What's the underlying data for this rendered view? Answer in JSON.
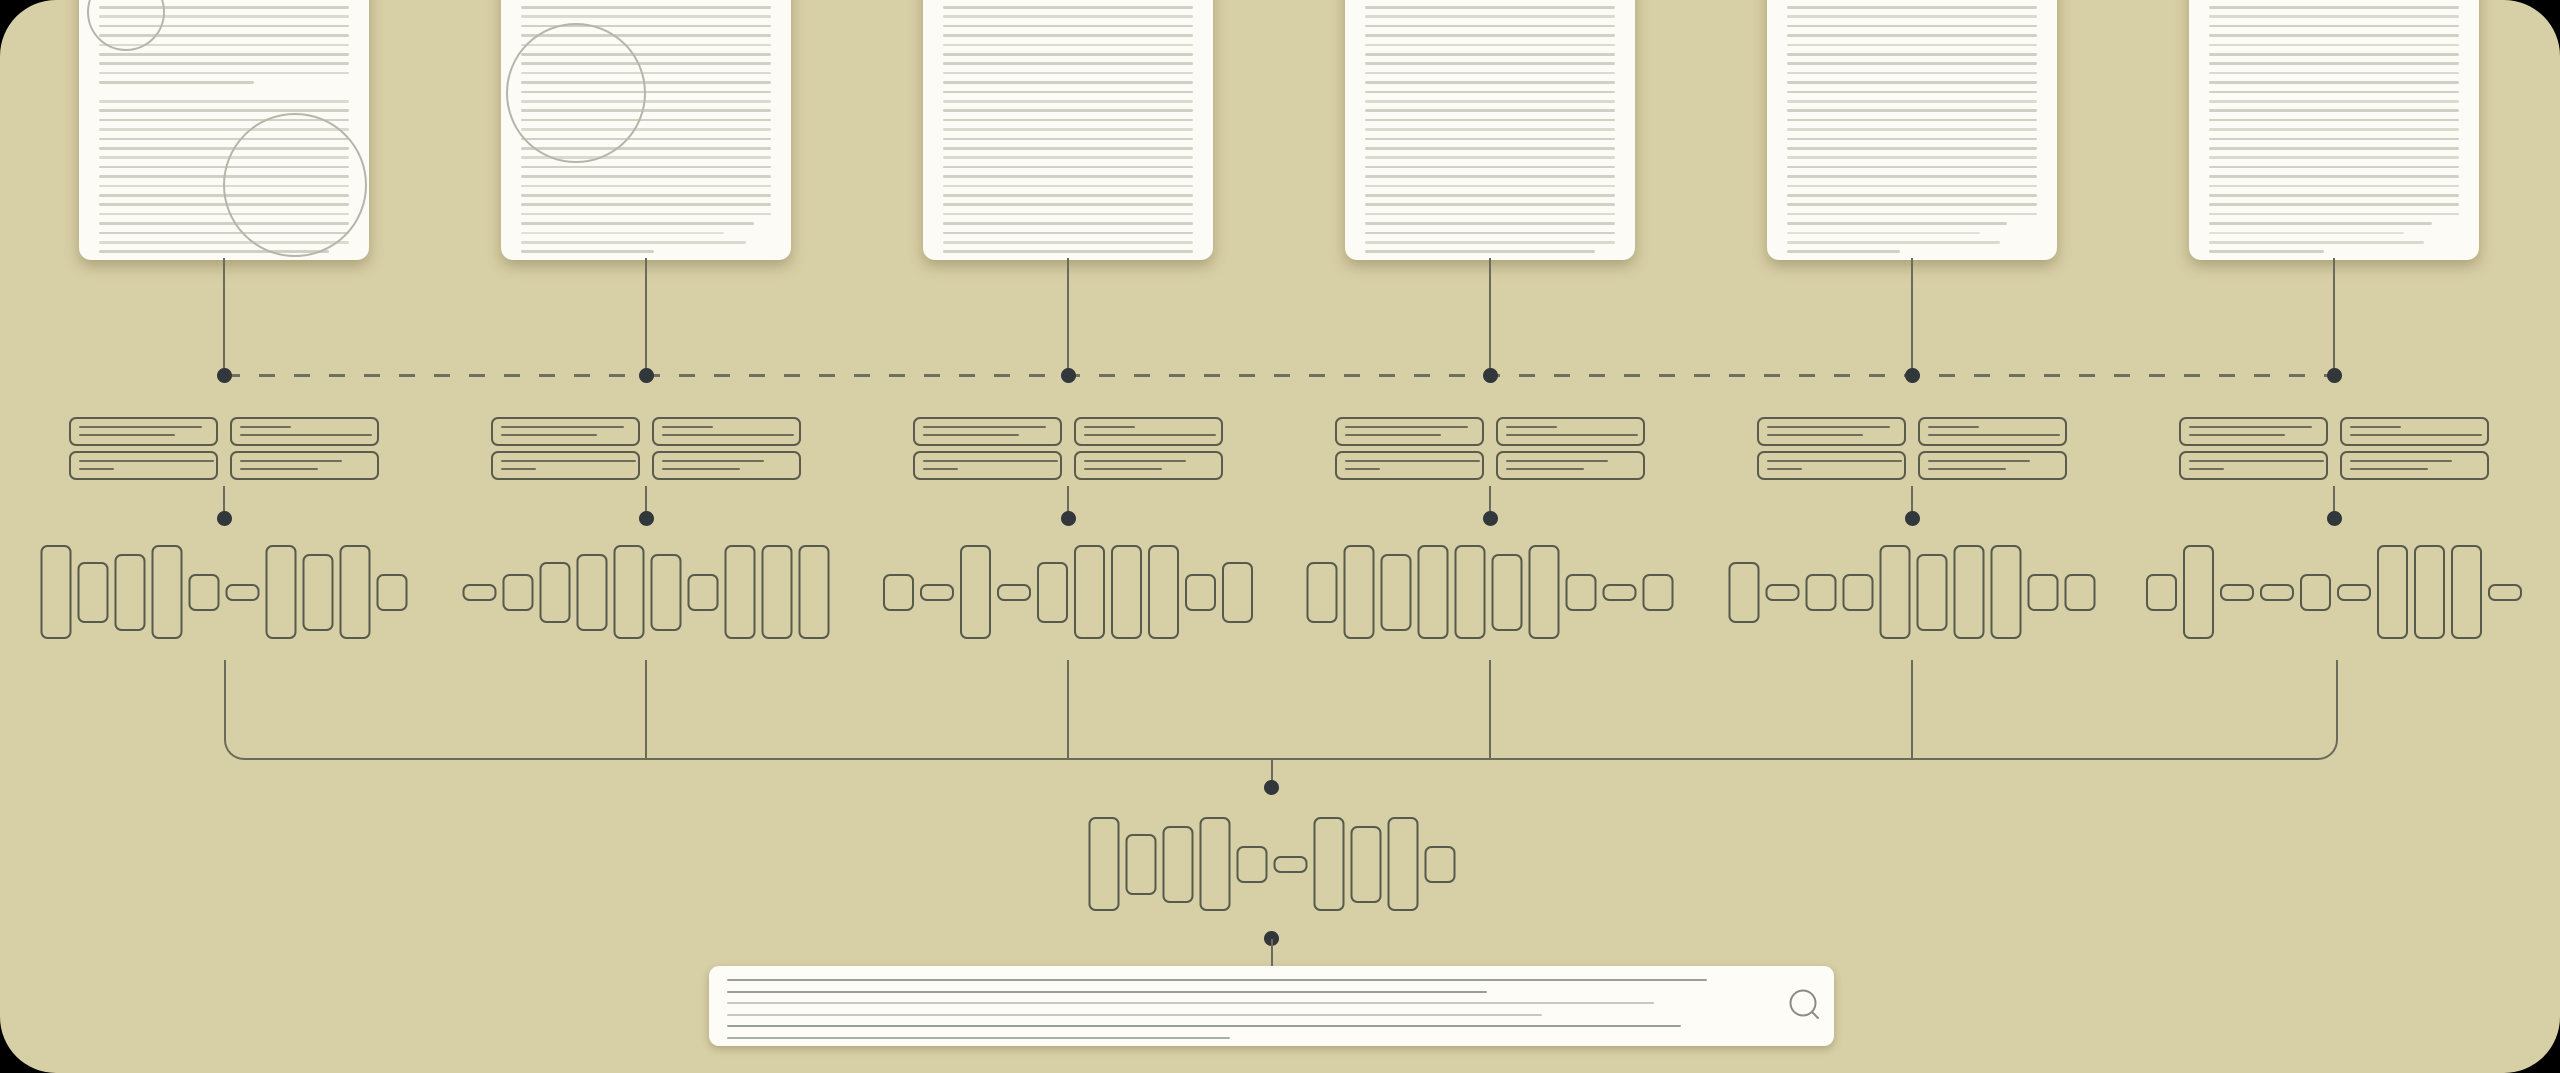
{
  "meta": {
    "title": "document-ingestion-and-search-pipeline-diagram"
  },
  "palette": {
    "outer": "#000000",
    "canvas": "#d7cfa5",
    "paper": "#fcfbf5",
    "paper_line": "#d2d0c5",
    "paper_line_mid": "#dcdacf",
    "paper_line_light": "#e3e1d7",
    "circle_stroke": "#b7b5a9",
    "connector": "#6b6b5c",
    "dashed": "#6f6f60",
    "dot": "#31373a",
    "card_border": "#5c5c4e",
    "card_line": "#6e6e5d",
    "token_border": "#565b4e",
    "search_bg": "#fdfcf7",
    "search_line_dark": "#9aa096",
    "search_line_mid": "#aab0a6",
    "search_line_light": "#c6c9bf",
    "icon": "#8a8d84"
  },
  "layout": {
    "doc_w": 290,
    "doc_top": -32,
    "doc_h": 292,
    "doc_pad": 20,
    "doc_line_start": 38,
    "doc_line_pitch": 9.4,
    "dash_y": 375,
    "card_row1_y": 417,
    "card_row2_y": 451,
    "stem2_top": 486,
    "dot2_y": 518,
    "token_y": 592,
    "bracket_top": 660,
    "bracket_bottom": 758,
    "center_x": 1272,
    "center_token_y": 864
  },
  "token_sizes": {
    "xl": [
      27,
      90
    ],
    "l": [
      27,
      73
    ],
    "m": [
      27,
      57
    ],
    "s": [
      27,
      33
    ],
    "pill": [
      30,
      13
    ]
  },
  "chunk_card_lines": [
    [
      85,
      66
    ],
    [
      35,
      91
    ],
    [
      93,
      24
    ],
    [
      70,
      54
    ]
  ],
  "columns": [
    {
      "center": 224,
      "doc": {
        "lines": [
          100,
          100,
          100,
          100,
          100,
          100,
          100,
          100,
          62,
          0,
          100,
          100,
          100,
          100,
          100,
          100,
          100,
          100,
          100,
          100,
          100,
          100,
          100,
          100,
          100,
          100,
          92
        ],
        "light": [],
        "circles": [
          {
            "cx": 45,
            "cy": 42,
            "r": 37
          },
          {
            "cx": 214,
            "cy": 215,
            "r": 70
          }
        ]
      },
      "tokens": [
        "xl",
        "m",
        "l",
        "xl",
        "s",
        "pill",
        "xl",
        "l",
        "xl",
        "s"
      ]
    },
    {
      "center": 646,
      "doc": {
        "lines": [
          100,
          100,
          100,
          100,
          100,
          100,
          100,
          100,
          100,
          100,
          100,
          100,
          100,
          100,
          100,
          100,
          100,
          100,
          100,
          100,
          100,
          100,
          100,
          93,
          81,
          90,
          53
        ],
        "light": [
          24
        ],
        "circles": [
          {
            "cx": 73,
            "cy": 123,
            "r": 68
          }
        ]
      },
      "tokens": [
        "pill",
        "s",
        "m",
        "l",
        "xl",
        "l",
        "s",
        "xl",
        "xl",
        "xl"
      ]
    },
    {
      "center": 1068,
      "doc": {
        "lines": [
          100,
          100,
          100,
          100,
          100,
          100,
          100,
          100,
          100,
          100,
          100,
          100,
          100,
          100,
          100,
          100,
          100,
          100,
          100,
          100,
          100,
          100,
          100,
          100,
          100,
          100,
          100
        ],
        "light": [],
        "circles": []
      },
      "tokens": [
        "s",
        "pill",
        "xl",
        "pill",
        "m",
        "xl",
        "xl",
        "xl",
        "s",
        "m"
      ]
    },
    {
      "center": 1490,
      "doc": {
        "lines": [
          100,
          100,
          100,
          100,
          100,
          100,
          100,
          100,
          100,
          100,
          100,
          100,
          100,
          100,
          100,
          100,
          100,
          100,
          100,
          100,
          100,
          100,
          100,
          100,
          100,
          100,
          92
        ],
        "light": [],
        "circles": []
      },
      "tokens": [
        "m",
        "xl",
        "l",
        "xl",
        "xl",
        "l",
        "xl",
        "s",
        "pill",
        "s"
      ]
    },
    {
      "center": 1912,
      "doc": {
        "lines": [
          100,
          100,
          100,
          100,
          100,
          100,
          100,
          100,
          100,
          100,
          100,
          100,
          100,
          100,
          100,
          100,
          100,
          100,
          100,
          100,
          100,
          100,
          100,
          88,
          77,
          85,
          45
        ],
        "light": [
          24
        ],
        "circles": []
      },
      "tokens": [
        "m",
        "pill",
        "s",
        "s",
        "xl",
        "l",
        "xl",
        "xl",
        "s",
        "s"
      ]
    },
    {
      "center": 2334,
      "doc": {
        "lines": [
          100,
          100,
          100,
          100,
          100,
          100,
          100,
          100,
          100,
          100,
          100,
          100,
          100,
          100,
          100,
          100,
          100,
          100,
          100,
          100,
          100,
          100,
          100,
          89,
          78,
          86,
          46
        ],
        "light": [
          24
        ],
        "circles": []
      },
      "tokens": [
        "s",
        "xl",
        "pill",
        "pill",
        "s",
        "pill",
        "xl",
        "xl",
        "xl",
        "pill"
      ]
    }
  ],
  "center_tokens": [
    "xl",
    "m",
    "l",
    "xl",
    "s",
    "pill",
    "xl",
    "l",
    "xl",
    "s"
  ],
  "search": {
    "lines": [
      {
        "w": 980,
        "tone": "dark"
      },
      {
        "w": 760,
        "tone": "dark"
      },
      {
        "w": 927,
        "tone": "light"
      },
      {
        "w": 815,
        "tone": "light"
      },
      {
        "w": 954,
        "tone": "dark"
      },
      {
        "w": 503,
        "tone": "mid"
      }
    ],
    "icon": "search-icon"
  }
}
